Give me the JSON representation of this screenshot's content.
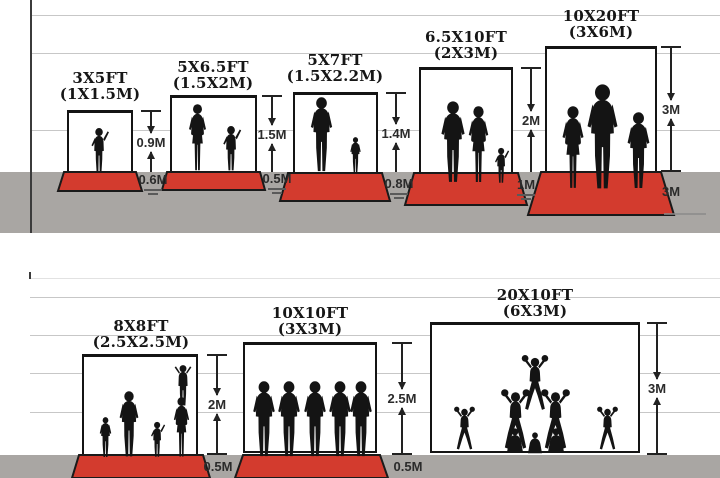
{
  "diagram": {
    "rows": [
      {
        "name": "top",
        "items": [
          {
            "size_ft": "3X5FT",
            "size_m": "(1X1.5M)",
            "wall_height": "0.9M",
            "floor_depth": "0.6M"
          },
          {
            "size_ft": "5X6.5FT",
            "size_m": "(1.5X2M)",
            "wall_height": "1.5M",
            "floor_depth": "0.5M"
          },
          {
            "size_ft": "5X7FT",
            "size_m": "(1.5X2.2M)",
            "wall_height": "1.4M",
            "floor_depth": "0.8M"
          },
          {
            "size_ft": "6.5X10FT",
            "size_m": "(2X3M)",
            "wall_height": "2M",
            "floor_depth": "1M"
          },
          {
            "size_ft": "10X20FT",
            "size_m": "(3X6M)",
            "wall_height": "3M",
            "floor_depth": "3M"
          }
        ]
      },
      {
        "name": "bottom",
        "items": [
          {
            "size_ft": "8X8FT",
            "size_m": "(2.5X2.5M)",
            "wall_height": "2M",
            "floor_depth": "0.5M"
          },
          {
            "size_ft": "10X10FT",
            "size_m": "(3X3M)",
            "wall_height": "2.5M",
            "floor_depth": "0.5M"
          },
          {
            "size_ft": "20X10FT",
            "size_m": "(6X3M)",
            "wall_height": "3M"
          }
        ]
      }
    ],
    "colors": {
      "mat_red": "#d33b2e",
      "ground_gray": "#a9a6a3",
      "silhouette_black": "#141414",
      "gridline_gray": "#c7c7c7",
      "frame_black": "#141414"
    }
  }
}
